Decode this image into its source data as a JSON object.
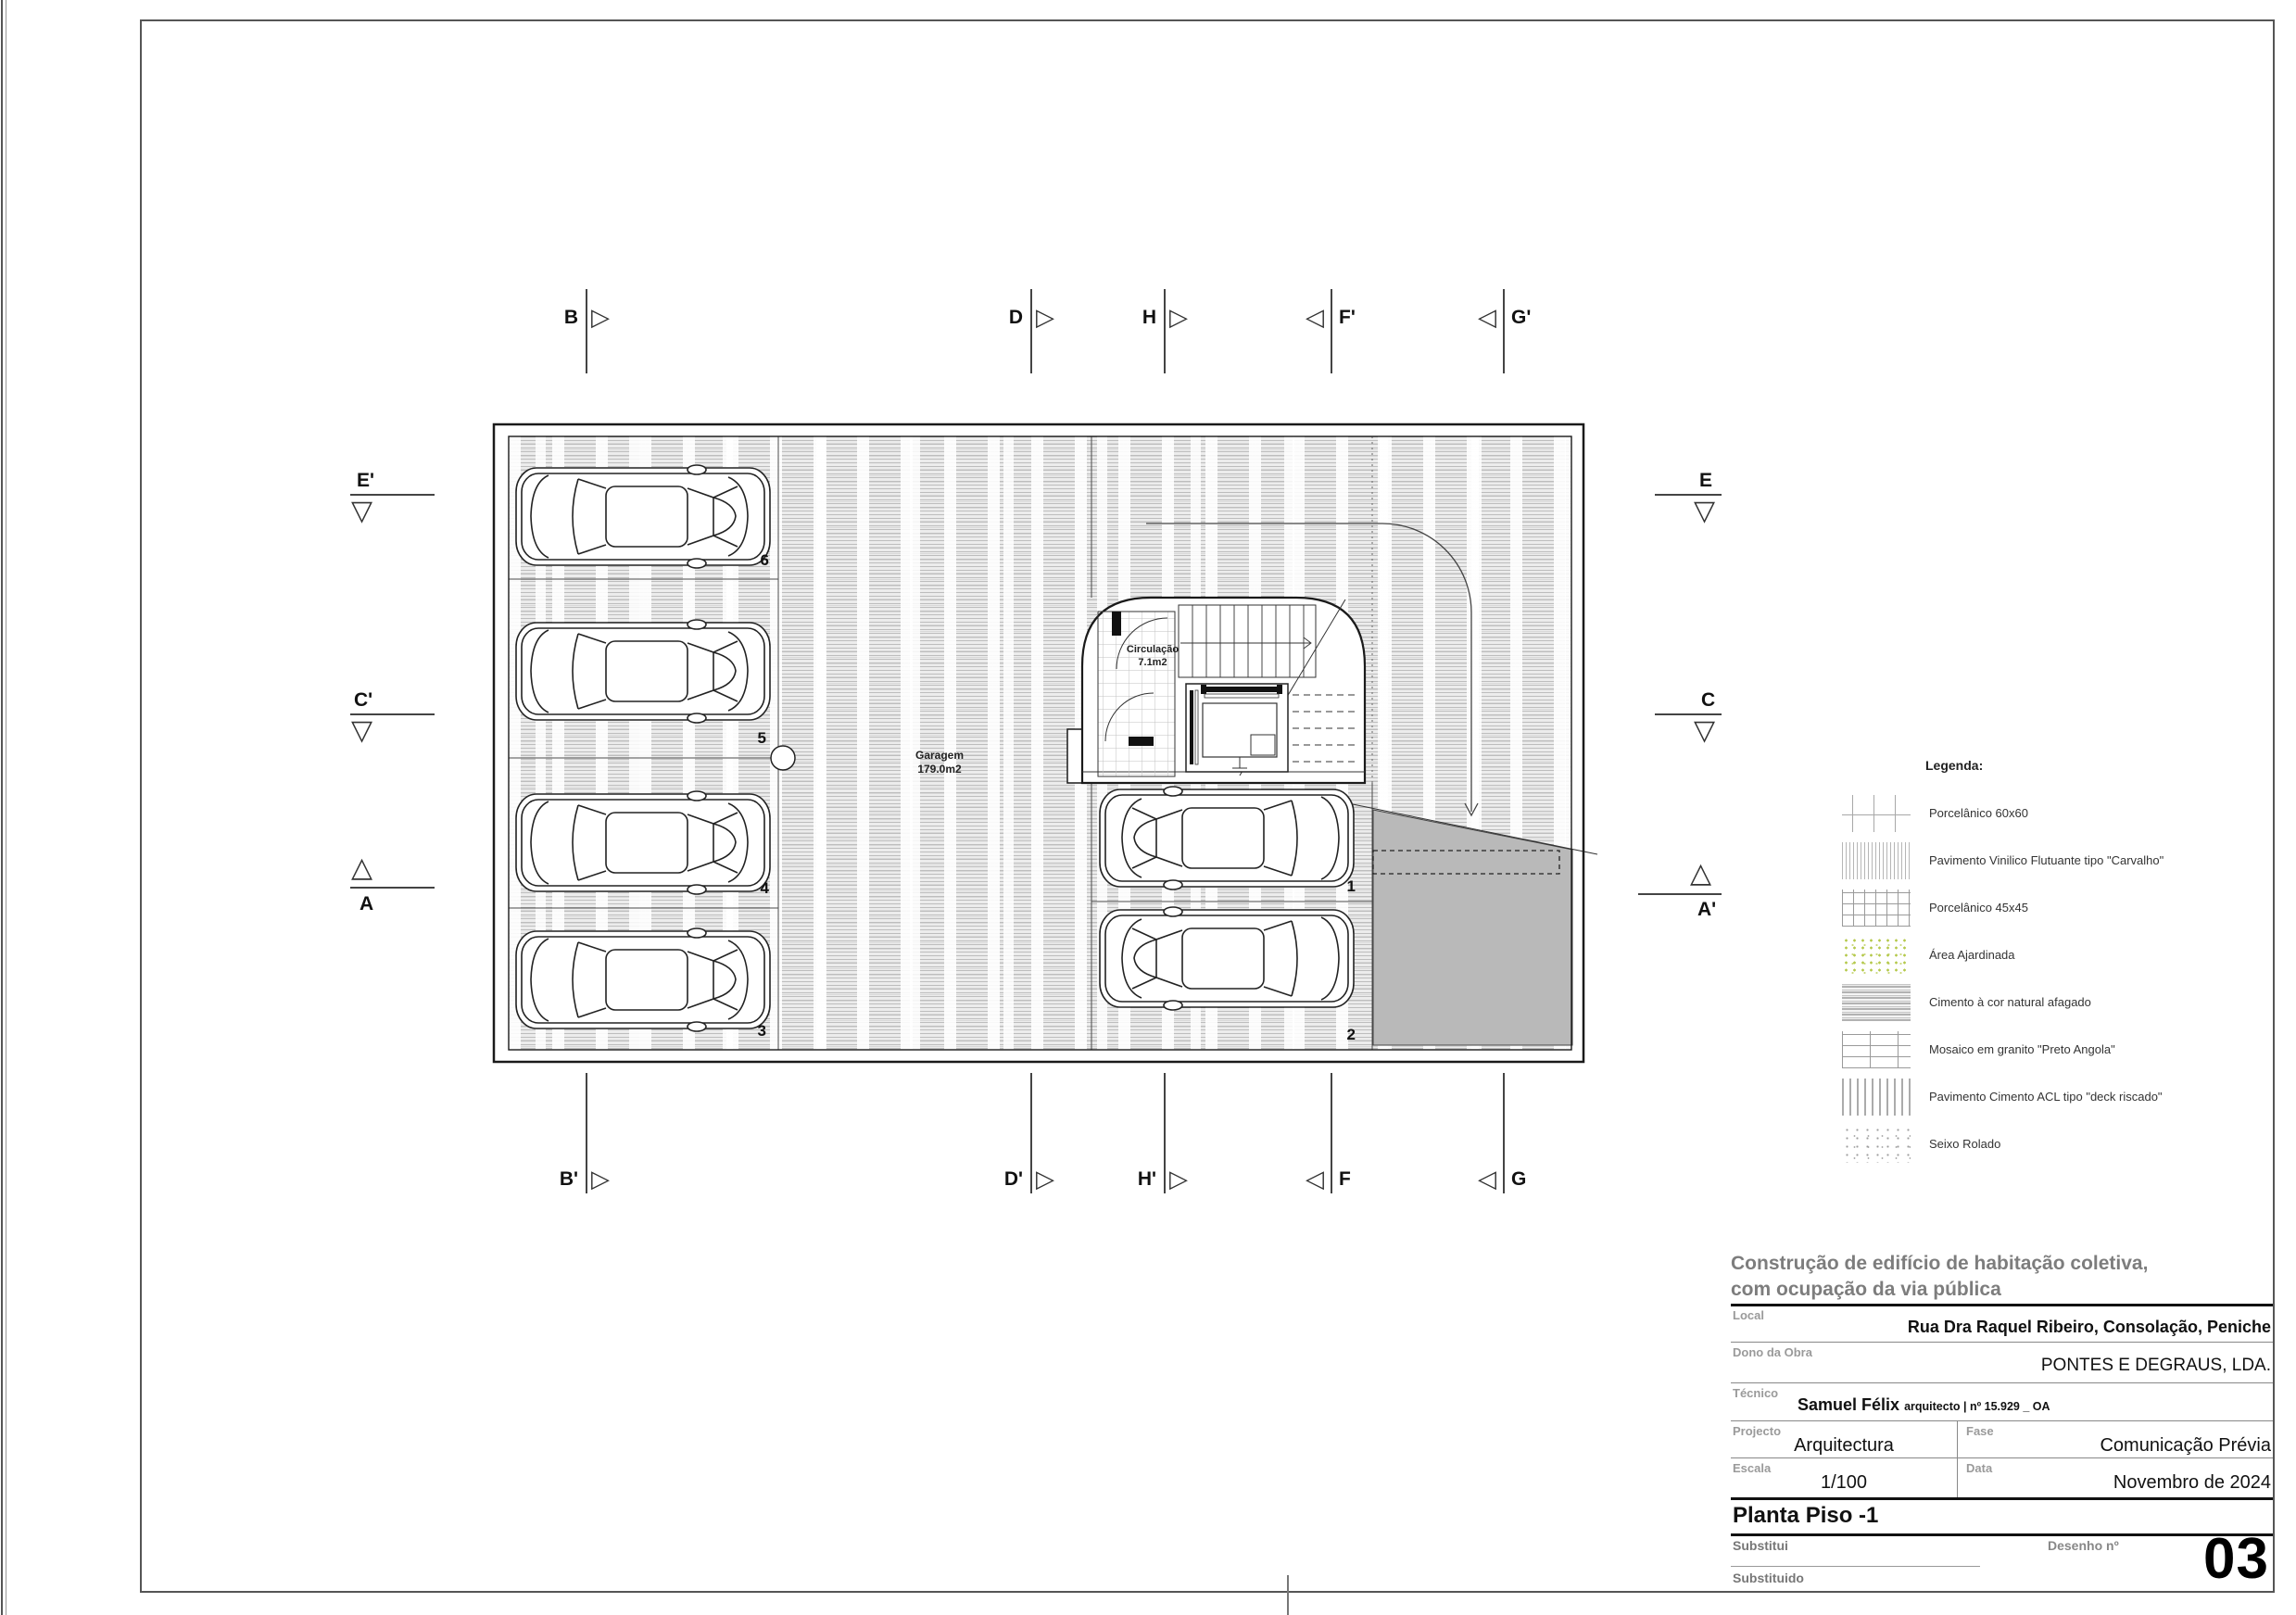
{
  "icons": {
    "tri_right": "▷",
    "tri_left": "◁",
    "tri_down": "▽",
    "tri_up": "△"
  },
  "drawing": {
    "garage_label": "Garagem",
    "garage_area": "179.0m2",
    "circulation_label": "Circulação",
    "circulation_area": "7.1m2",
    "stalls": [
      "1",
      "2",
      "3",
      "4",
      "5",
      "6"
    ]
  },
  "markers": {
    "top": [
      {
        "label": "B"
      },
      {
        "label": "D"
      },
      {
        "label": "H"
      },
      {
        "label": "F'"
      },
      {
        "label": "G'"
      }
    ],
    "bottom": [
      {
        "label": "B'"
      },
      {
        "label": "D'"
      },
      {
        "label": "H'"
      },
      {
        "label": "F"
      },
      {
        "label": "G"
      }
    ],
    "left": [
      {
        "label": "E'"
      },
      {
        "label": "C'"
      },
      {
        "label": "A"
      }
    ],
    "right": [
      {
        "label": "E"
      },
      {
        "label": "C"
      },
      {
        "label": "A'"
      }
    ]
  },
  "legend": {
    "title": "Legenda:",
    "items": [
      {
        "label": "Porcelânico 60x60"
      },
      {
        "label": "Pavimento Vinilico Flutuante tipo \"Carvalho\""
      },
      {
        "label": "Porcelânico 45x45"
      },
      {
        "label": "Área Ajardinada"
      },
      {
        "label": "Cimento à cor natural afagado"
      },
      {
        "label": "Mosaico em granito \"Preto Angola\""
      },
      {
        "label": "Pavimento Cimento ACL tipo \"deck riscado\""
      },
      {
        "label": "Seixo Rolado"
      }
    ]
  },
  "title_block": {
    "project_title_line1": "Construção de edifício de habitação coletiva,",
    "project_title_line2": "com ocupação da via pública",
    "local_label": "Local",
    "local_value": "Rua Dra Raquel Ribeiro, Consolação, Peniche",
    "owner_label": "Dono da Obra",
    "owner_value": "PONTES E DEGRAUS, LDA.",
    "technician_label": "Técnico",
    "technician_name": "Samuel Félix",
    "technician_suffix": "arquitecto | nº 15.929 _ OA",
    "project_label": "Projecto",
    "project_value": "Arquitectura",
    "phase_label": "Fase",
    "phase_value": "Comunicação Prévia",
    "scale_label": "Escala",
    "scale_value": "1/100",
    "date_label": "Data",
    "date_value": "Novembro de 2024",
    "sheet_title": "Planta Piso -1",
    "substitui_label": "Substitui",
    "substituido_label": "Substituido",
    "drawing_no_label": "Desenho nº",
    "drawing_no": "03"
  },
  "colors": {
    "hatch_gray": "#c4c4c4",
    "ramp_gray": "#b9b9b9",
    "garden_green": "#b5c94c",
    "line_dark": "#1a1a1a"
  }
}
